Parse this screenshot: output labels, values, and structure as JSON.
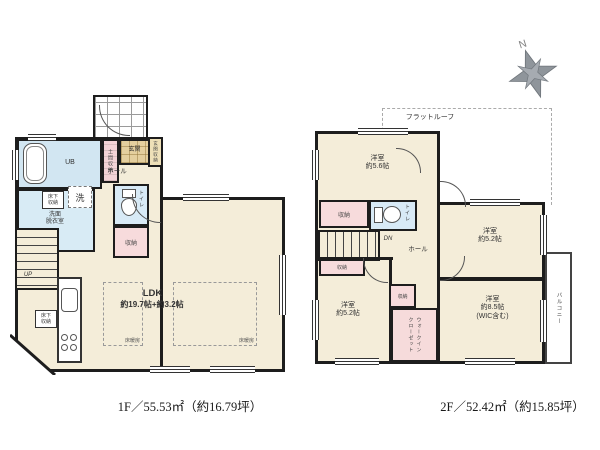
{
  "compass": {
    "north_label": "N"
  },
  "floor1": {
    "caption": "1F／55.53㎡（約16.79坪）",
    "rooms": {
      "ldk_name": "LDK",
      "ldk_size": "約19.7帖+約3.2帖",
      "bath": "UB",
      "washroom": "洗面\n脱衣室",
      "washer": "洗",
      "underfloor": "床下\n収納",
      "doma_storage": "土間収納",
      "entrance": "玄関",
      "entrance_storage": "玄関収納",
      "hall": "ホール",
      "toilet": "トイレ",
      "storage": "収納",
      "stairs_up": "UP",
      "floor_heating1": "床暖房",
      "floor_heating2": "床暖房"
    }
  },
  "floor2": {
    "caption": "2F／52.42㎡（約15.85坪）",
    "flat_roof": "フラットルーフ",
    "rooms": {
      "bedroom_56": "洋室\n約5.6帖",
      "bedroom_52_right": "洋室\n約5.2帖",
      "bedroom_52_left": "洋室\n約5.2帖",
      "bedroom_85": "洋室\n約8.5帖\n(WIC含む)",
      "wic": "ウォークイン\nクローゼット",
      "hall": "ホール",
      "toilet": "トイレ",
      "storage_top": "収納",
      "storage_mid": "収納",
      "storage_left": "収納",
      "stairs_down": "DN",
      "balcony": "バルコニー"
    }
  },
  "colors": {
    "wall": "#1d1d1d",
    "room_cream": "#f4edd9",
    "water_blue": "#d8eaf6",
    "storage_pink": "#f7dbdc",
    "entrance_tan": "#e4cf9e",
    "compass_gray": "#8f959b"
  }
}
